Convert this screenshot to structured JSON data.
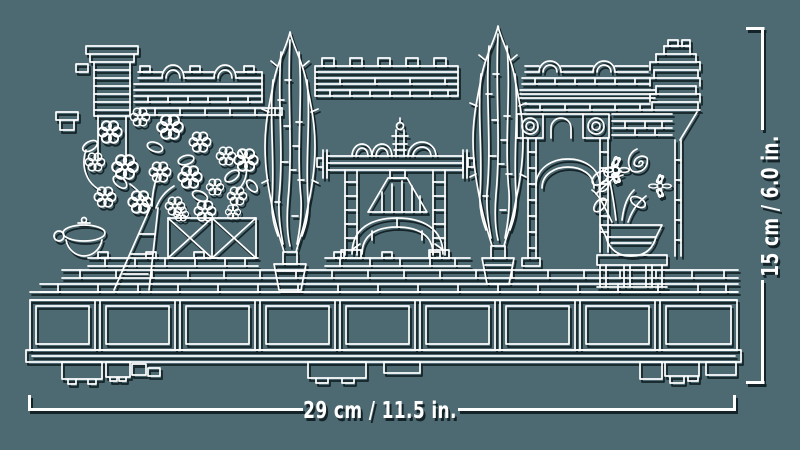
{
  "scene": {
    "kind": "product-dimension-diagram",
    "illustration_alt": "White outline line art of a LEGO garden diorama: blossom tree, two tall cypress trees, a moon gate with arched bridge, garden walls and potted flowers on a long sectioned display base",
    "colors": {
      "background": "#4d6971",
      "line_art": "#ffffff",
      "shadow": "#14262b",
      "label_text": "#ffffff"
    }
  },
  "dimensions": {
    "width_label": "29 cm / 11.5 in.",
    "height_label": "15 cm / 6.0 in."
  }
}
